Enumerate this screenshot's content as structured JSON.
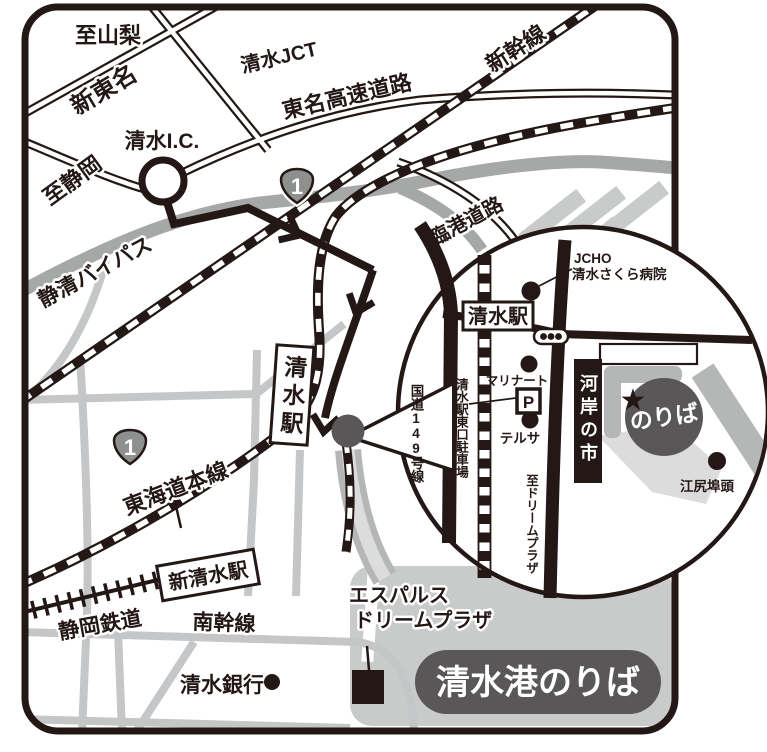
{
  "title": "清水港のりば案内図",
  "map": {
    "region_labels": {
      "to_yamanashi": "至山梨",
      "shin_tomei": "新東名",
      "shimizu_jct": "清水JCT",
      "tomei_expressway": "東名高速道路",
      "shinkansen": "新幹線",
      "shimizu_ic": "清水I.C.",
      "to_shizuoka": "至静岡",
      "seishin_bypass": "静清バイパス",
      "rinko_road": "臨港道路",
      "route1_number": "1",
      "shimizu_station": "清水駅",
      "tokaido_main_line": "東海道本線",
      "shin_shimizu_station": "新清水駅",
      "shizuoka_railway": "静岡鉄道",
      "minami_kansen": "南幹線",
      "shimizu_bank": "清水銀行",
      "espulse_line1": "エスパルス",
      "espulse_line2": "ドリームプラザ",
      "port_label": "清水港のりば"
    }
  },
  "inset": {
    "hospital_line1": "JCHO",
    "hospital_line2": "清水さくら病院",
    "station": "清水駅",
    "marinart": "マリナート",
    "parking_mark": "P",
    "east_parking": "清水駅東口駐車場",
    "terrsa": "テルサ",
    "route149": "国道149号線",
    "to_dream_plaza": "至ドリームプラザ",
    "kashi_no_ichi": "河岸の市",
    "boarding": "のりば",
    "boarding_star": "★",
    "ejiri_wharf": "江尻埠頭"
  },
  "colors": {
    "road": "#231815",
    "accent_dark": "#595757",
    "gray_road": "#c5c6c7",
    "bypass_gray": "#a6a7a7",
    "sea_gray": "#c9caca"
  }
}
